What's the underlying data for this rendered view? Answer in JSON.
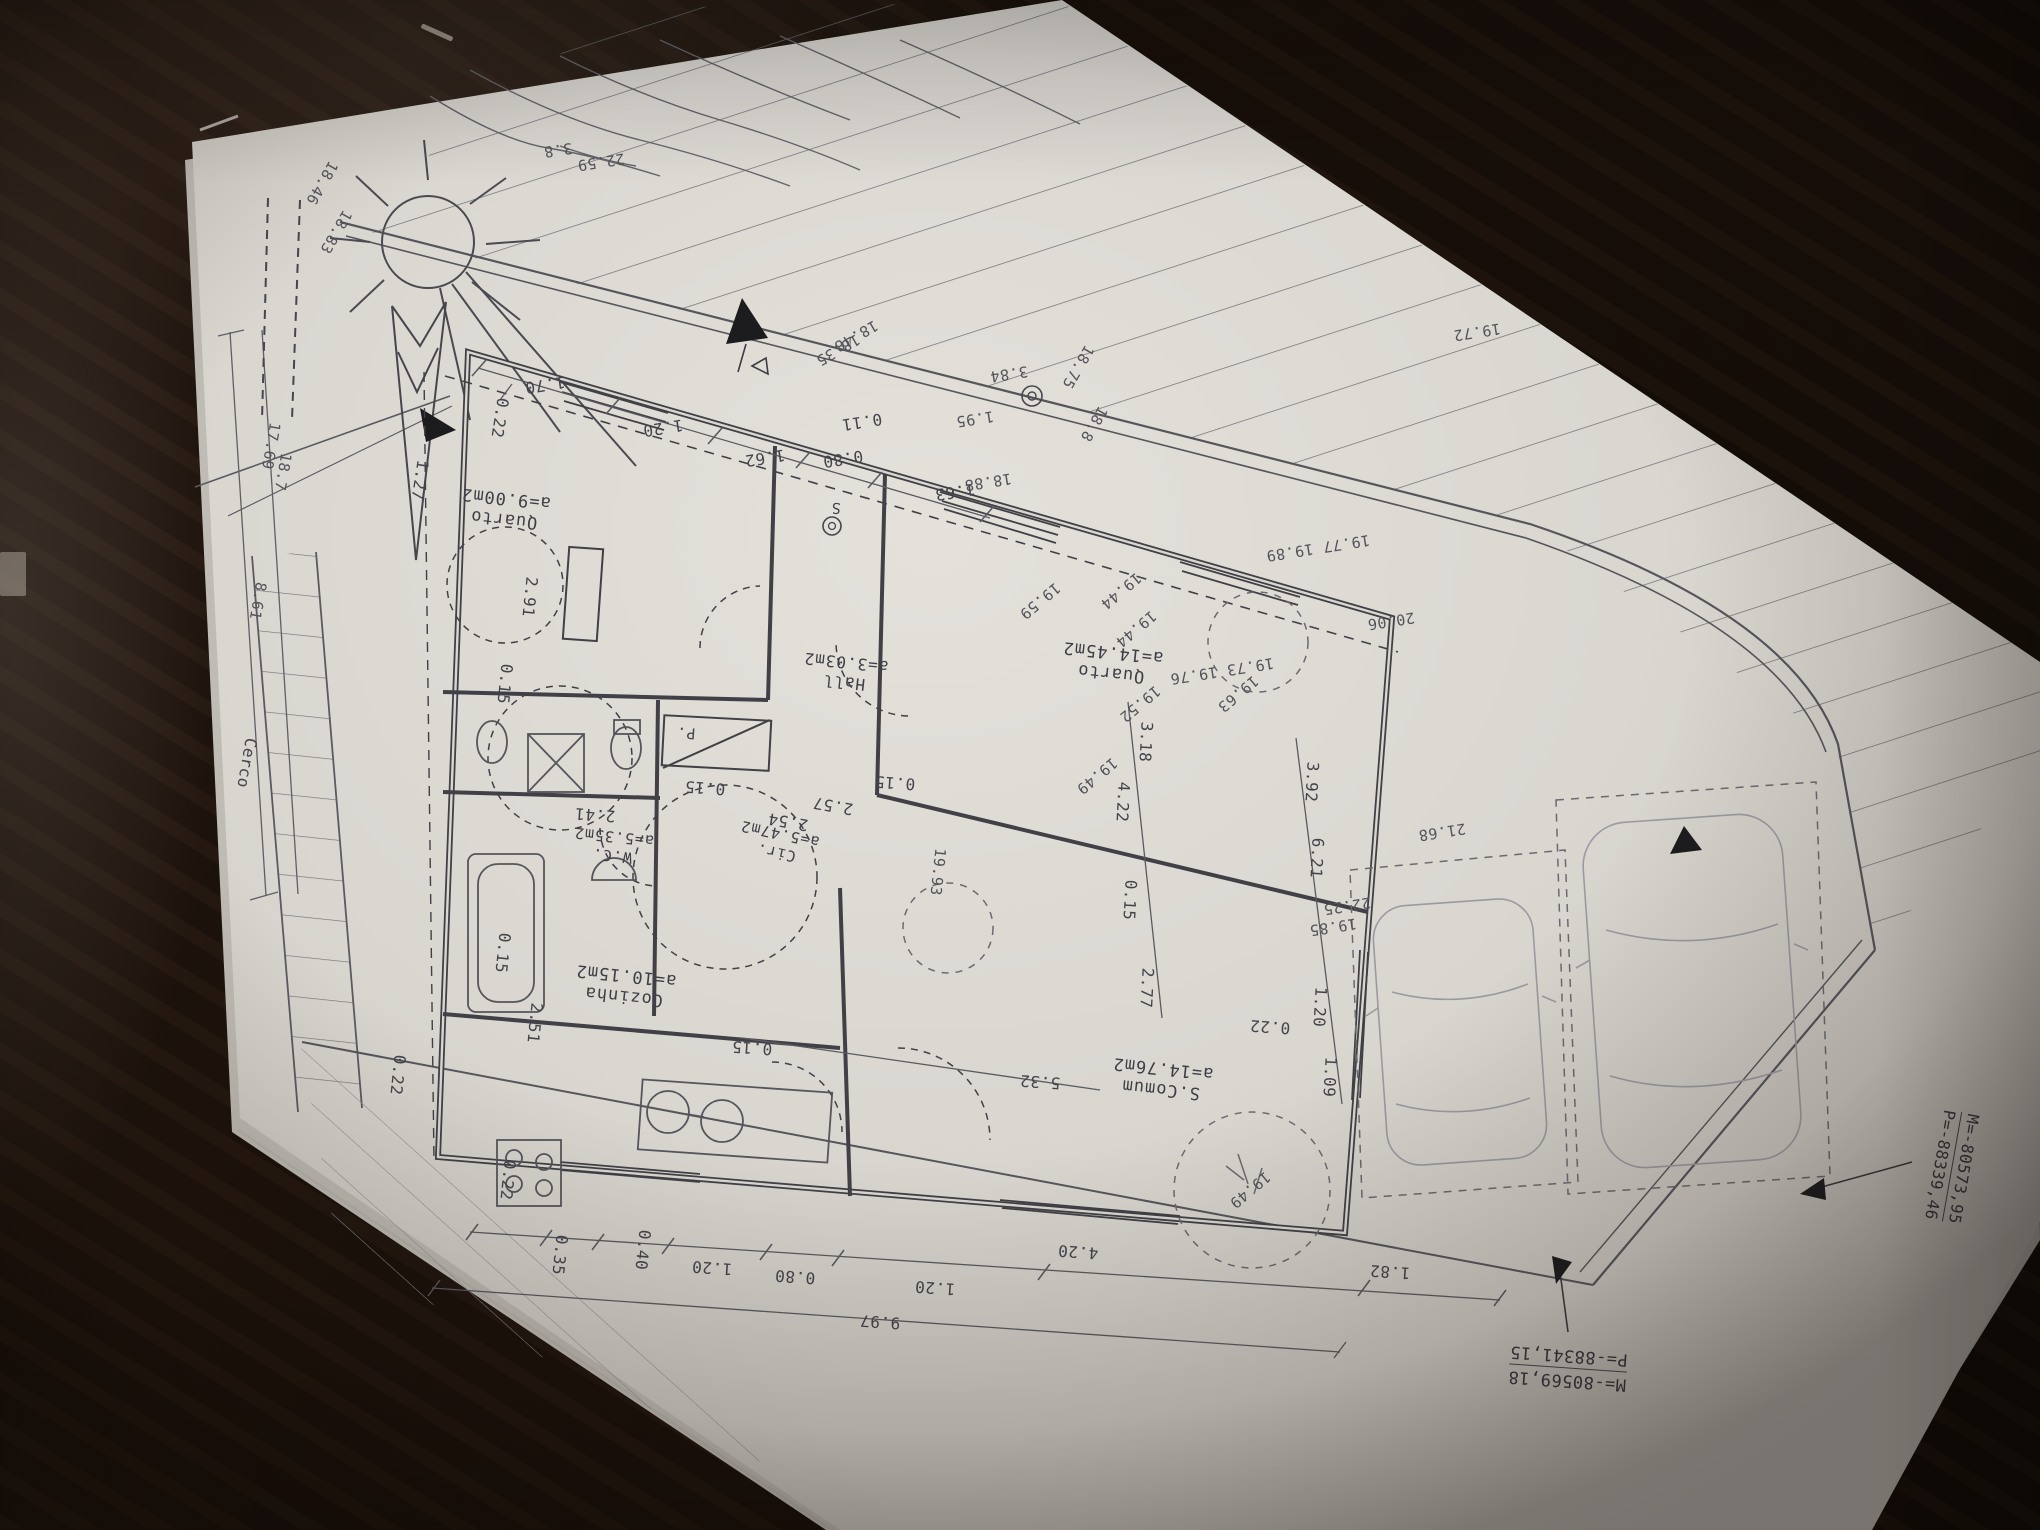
{
  "photo": {
    "description": "Photograph of an architectural site/floor plan sheet lying upside-down on a dark wooden table",
    "paper_color": "#dad7d1",
    "table_color": "#1a100a",
    "ink_color": "#47474c"
  },
  "plan": {
    "rooms": [
      {
        "name": "Quarto",
        "area": "a=9.00m2"
      },
      {
        "name": "Hall",
        "area": "a=3.03m2"
      },
      {
        "name": "Quarto",
        "area": "a=14.45m2"
      },
      {
        "name": "W.C.",
        "area": "a=5.35m2"
      },
      {
        "name": "Cir.",
        "area": "a=5.47m2"
      },
      {
        "name": "Cozinha",
        "area": "a=10.15m2"
      },
      {
        "name": "S.Comum",
        "area": "a=14.76m2"
      }
    ],
    "dims": [
      "1.70",
      "1.20",
      "1.62",
      "0.80",
      "0.11",
      "1.63",
      "0.22",
      "1.27",
      "2.91",
      "0.15",
      "0.15",
      "2.51",
      "0.22",
      "0.22",
      "2.41",
      "2.57",
      "2.54",
      "0.15",
      "0.15",
      "5.32",
      "3.18",
      "4.22",
      "0.15",
      "2.77",
      "3.92",
      "6.21",
      "1.20",
      "1.09",
      "0.22",
      "0.35",
      "0.40",
      "1.20",
      "0.80",
      "1.20",
      "4.20",
      "1.82",
      "9.97",
      "0.15"
    ],
    "levels": [
      "18.46",
      "18.83",
      "3.8",
      "22.59",
      "18.48",
      "18.35",
      "1.95",
      "3.84",
      "18.75",
      "18.8",
      "18.88",
      "19.72",
      "19.77 19.89",
      "20.06",
      "19.44",
      "19.44",
      "19.59",
      "19.52",
      "19.49",
      "19.73 19.76",
      "19.63",
      "21.68",
      "22.25",
      "19.85",
      "8.61",
      "17.69",
      "18.7",
      "19.93",
      "19.49"
    ],
    "misc": {
      "fence": "Cerco",
      "closet": "P.",
      "switch": "S"
    },
    "coords": {
      "block1_m": "M=-80569,18",
      "block1_p": "P=-88341,15",
      "block2_m": "M=-80573,95",
      "block2_p": "P=-88339,46"
    }
  }
}
